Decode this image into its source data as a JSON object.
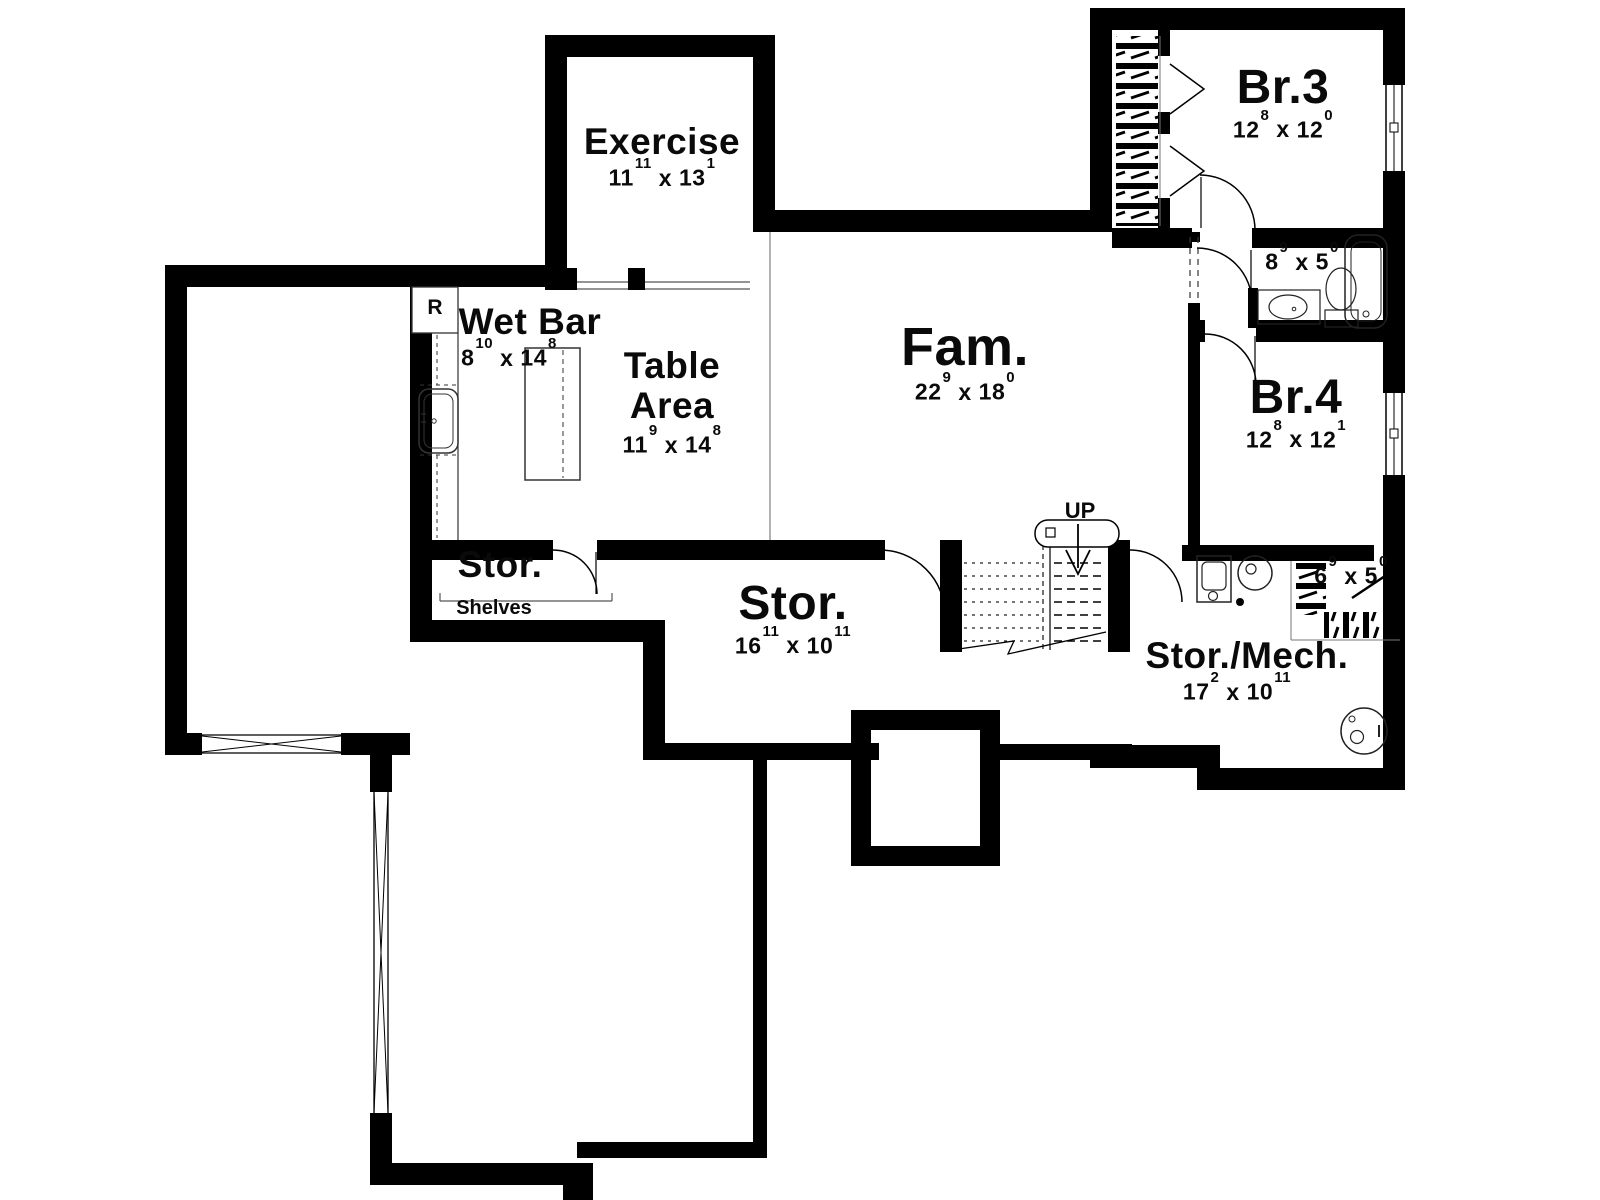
{
  "rooms": {
    "exercise": {
      "name": "Exercise",
      "dims": {
        "w_ft": "11",
        "w_in": "11",
        "h_ft": "13",
        "h_in": "1"
      }
    },
    "wet_bar": {
      "name": "Wet Bar",
      "dims": {
        "w_ft": "8",
        "w_in": "10",
        "h_ft": "14",
        "h_in": "8"
      }
    },
    "table_area": {
      "name": "Table Area",
      "dims": {
        "w_ft": "11",
        "w_in": "9",
        "h_ft": "14",
        "h_in": "8"
      }
    },
    "family": {
      "name": "Fam.",
      "dims": {
        "w_ft": "22",
        "w_in": "9",
        "h_ft": "18",
        "h_in": "0"
      }
    },
    "bedroom3": {
      "name": "Br.3",
      "dims": {
        "w_ft": "12",
        "w_in": "8",
        "h_ft": "12",
        "h_in": "0"
      }
    },
    "bedroom4": {
      "name": "Br.4",
      "dims": {
        "w_ft": "12",
        "w_in": "8",
        "h_ft": "12",
        "h_in": "1"
      }
    },
    "bath": {
      "dims": {
        "w_ft": "8",
        "w_in": "9",
        "h_ft": "5",
        "h_in": "0"
      }
    },
    "storage_small": {
      "name": "Stor.",
      "note": "Shelves"
    },
    "storage_main": {
      "name": "Stor.",
      "dims": {
        "w_ft": "16",
        "w_in": "11",
        "h_ft": "10",
        "h_in": "11"
      }
    },
    "storage_mech": {
      "name": "Stor./Mech.",
      "dims": {
        "w_ft": "17",
        "w_in": "2",
        "h_ft": "10",
        "h_in": "11"
      }
    },
    "closet": {
      "dims": {
        "w_ft": "6",
        "w_in": "9",
        "h_ft": "5",
        "h_in": "0"
      }
    }
  },
  "annotations": {
    "up": "UP",
    "refrigerator": "R",
    "dim_separator": "x"
  },
  "colors": {
    "walls": "#000000",
    "background": "#ffffff",
    "thin_lines": "#555555"
  }
}
